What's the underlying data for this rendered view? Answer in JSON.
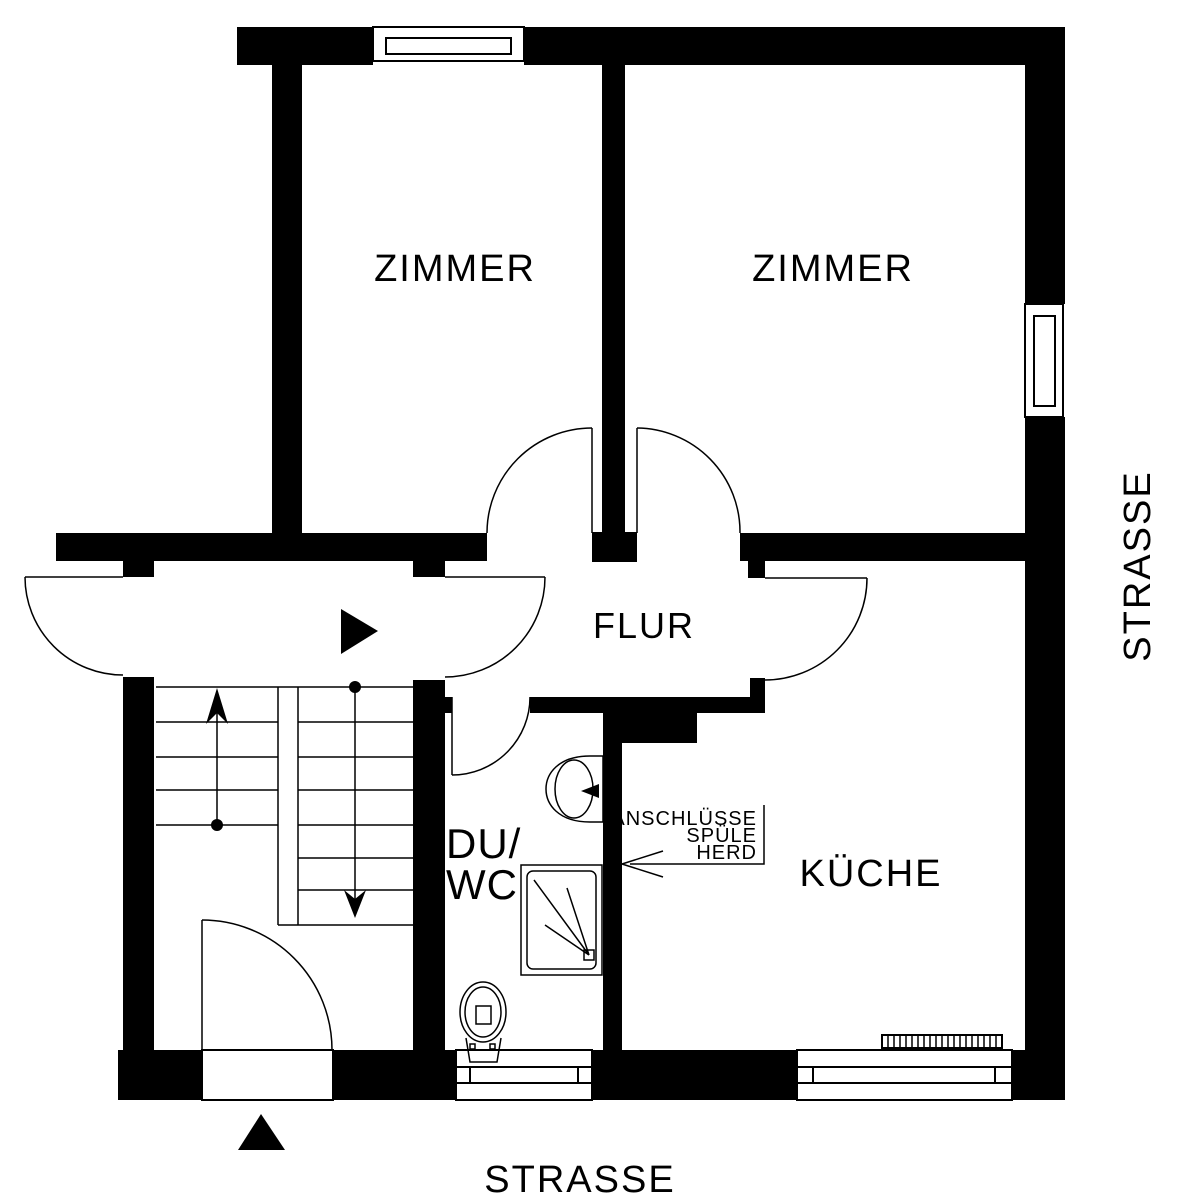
{
  "floorplan": {
    "labels": {
      "room_zimmer_left": "ZIMMER",
      "room_zimmer_right": "ZIMMER",
      "room_flur": "FLUR",
      "room_duwc_line1": "DU/",
      "room_duwc_line2": "WC",
      "room_kueche": "KÜCHE",
      "street_right": "STRASSE",
      "street_bottom": "STRASSE",
      "annotation_line1": "ANSCHLÜSSE",
      "annotation_line2": "SPÜLE",
      "annotation_line3": "HERD"
    },
    "colors": {
      "wall": "#000000",
      "line": "#000000",
      "background": "#ffffff"
    },
    "symbols": [
      "door-swing-arc",
      "window",
      "radiator",
      "sink",
      "shower-tray",
      "toilet",
      "stairs-up-arrow",
      "stairs-down-arrow",
      "landing-direction-triangle",
      "entrance-triangle",
      "connection-leader-arrow"
    ]
  }
}
